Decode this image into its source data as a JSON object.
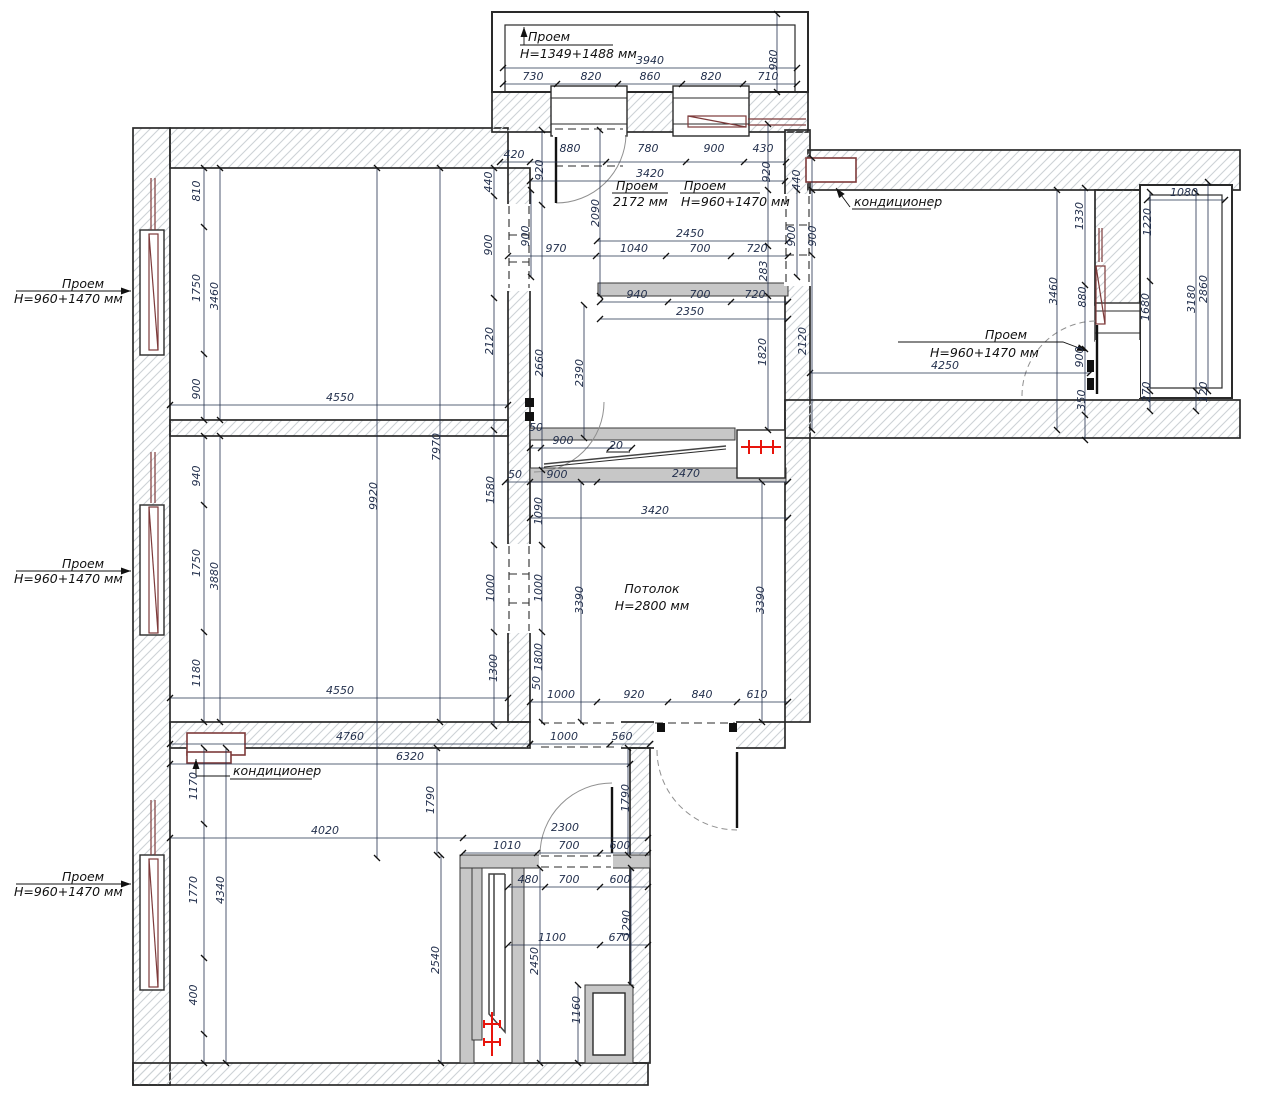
{
  "colors": {
    "dim_text": "#23304d",
    "wall_line": "#2a2a2a",
    "hatch": "#cdd2d6",
    "partition_gray": "#c7c7c7",
    "radiator_red": "#e8140c",
    "window_maroon": "#7d3a3a",
    "door_arc_gray": "#909090"
  },
  "labels": {
    "opening_top": {
      "title": "Проем",
      "size": "H=1349+1488 мм"
    },
    "opening_kitchen": {
      "title": "Проем",
      "size": "2172 мм"
    },
    "opening_kitchen_2": {
      "title": "Проем",
      "size": "H=960+1470 мм"
    },
    "opening_right": {
      "title": "Проем",
      "size": "H=960+1470 мм"
    },
    "opening_left_top": {
      "title": "Проем",
      "size": "H=960+1470 мм"
    },
    "opening_left_middle": {
      "title": "Проем",
      "size": "H=960+1470 мм"
    },
    "opening_left_bottom": {
      "title": "Проем",
      "size": "H=960+1470 мм"
    },
    "ceiling": {
      "title": "Потолок",
      "size": "H=2800 мм"
    },
    "ac_top_right": "кондиционер",
    "ac_bottom_left": "кондиционер"
  },
  "dims": [
    {
      "t": "3940",
      "x": 650,
      "y": 64
    },
    {
      "t": "730",
      "x": 533,
      "y": 80
    },
    {
      "t": "820",
      "x": 591,
      "y": 80
    },
    {
      "t": "860",
      "x": 650,
      "y": 80
    },
    {
      "t": "820",
      "x": 711,
      "y": 80
    },
    {
      "t": "710",
      "x": 768,
      "y": 80
    },
    {
      "t": "980",
      "x": 777,
      "y": 60,
      "r": -90
    },
    {
      "t": "420",
      "x": 514,
      "y": 158
    },
    {
      "t": "880",
      "x": 570,
      "y": 152
    },
    {
      "t": "780",
      "x": 648,
      "y": 152
    },
    {
      "t": "900",
      "x": 714,
      "y": 152
    },
    {
      "t": "430",
      "x": 763,
      "y": 152
    },
    {
      "t": "920",
      "x": 543,
      "y": 170,
      "r": -90
    },
    {
      "t": "920",
      "x": 770,
      "y": 172,
      "r": -90
    },
    {
      "t": "3420",
      "x": 650,
      "y": 177
    },
    {
      "t": "2090",
      "x": 599,
      "y": 213,
      "r": -90
    },
    {
      "t": "900",
      "x": 529,
      "y": 236,
      "r": -90
    },
    {
      "t": "900",
      "x": 795,
      "y": 236,
      "r": -90
    },
    {
      "t": "900",
      "x": 816,
      "y": 236,
      "r": -90
    },
    {
      "t": "2450",
      "x": 690,
      "y": 237
    },
    {
      "t": "970",
      "x": 556,
      "y": 252
    },
    {
      "t": "1040",
      "x": 634,
      "y": 252
    },
    {
      "t": "700",
      "x": 700,
      "y": 252
    },
    {
      "t": "720",
      "x": 757,
      "y": 252
    },
    {
      "t": "283",
      "x": 767,
      "y": 271,
      "r": -90
    },
    {
      "t": "940",
      "x": 637,
      "y": 298
    },
    {
      "t": "700",
      "x": 700,
      "y": 298
    },
    {
      "t": "720",
      "x": 755,
      "y": 298
    },
    {
      "t": "2350",
      "x": 690,
      "y": 315
    },
    {
      "t": "1820",
      "x": 766,
      "y": 352,
      "r": -90
    },
    {
      "t": "2120",
      "x": 493,
      "y": 341,
      "r": -90
    },
    {
      "t": "2120",
      "x": 806,
      "y": 341,
      "r": -90
    },
    {
      "t": "2660",
      "x": 543,
      "y": 363,
      "r": -90
    },
    {
      "t": "2390",
      "x": 583,
      "y": 373,
      "r": -90
    },
    {
      "t": "810",
      "x": 200,
      "y": 191,
      "r": -90
    },
    {
      "t": "1750",
      "x": 200,
      "y": 288,
      "r": -90
    },
    {
      "t": "900",
      "x": 200,
      "y": 389,
      "r": -90
    },
    {
      "t": "3460",
      "x": 218,
      "y": 296,
      "r": -90
    },
    {
      "t": "440",
      "x": 492,
      "y": 182,
      "r": -90
    },
    {
      "t": "900",
      "x": 492,
      "y": 245,
      "r": -90
    },
    {
      "t": "4550",
      "x": 340,
      "y": 401
    },
    {
      "t": "4550",
      "x": 340,
      "y": 694
    },
    {
      "t": "7970",
      "x": 440,
      "y": 447,
      "r": -90
    },
    {
      "t": "9920",
      "x": 377,
      "y": 496,
      "r": -90
    },
    {
      "t": "940",
      "x": 200,
      "y": 476,
      "r": -90
    },
    {
      "t": "1750",
      "x": 200,
      "y": 563,
      "r": -90
    },
    {
      "t": "1180",
      "x": 200,
      "y": 673,
      "r": -90
    },
    {
      "t": "3880",
      "x": 218,
      "y": 576,
      "r": -90
    },
    {
      "t": "1580",
      "x": 494,
      "y": 490,
      "r": -90
    },
    {
      "t": "1090",
      "x": 542,
      "y": 511,
      "r": -90
    },
    {
      "t": "1000",
      "x": 494,
      "y": 588,
      "r": -90
    },
    {
      "t": "1000",
      "x": 542,
      "y": 588,
      "r": -90
    },
    {
      "t": "1300",
      "x": 497,
      "y": 668,
      "r": -90
    },
    {
      "t": "1800",
      "x": 542,
      "y": 657,
      "r": -90
    },
    {
      "t": "3390",
      "x": 583,
      "y": 600,
      "r": -90
    },
    {
      "t": "3390",
      "x": 764,
      "y": 600,
      "r": -90
    },
    {
      "t": "50",
      "x": 536,
      "y": 431
    },
    {
      "t": "900",
      "x": 563,
      "y": 444
    },
    {
      "t": "20",
      "x": 616,
      "y": 449
    },
    {
      "t": "50",
      "x": 515,
      "y": 478
    },
    {
      "t": "900",
      "x": 557,
      "y": 478
    },
    {
      "t": "2470",
      "x": 686,
      "y": 477
    },
    {
      "t": "3420",
      "x": 655,
      "y": 514
    },
    {
      "t": "1000",
      "x": 561,
      "y": 698
    },
    {
      "t": "920",
      "x": 634,
      "y": 698
    },
    {
      "t": "840",
      "x": 702,
      "y": 698
    },
    {
      "t": "610",
      "x": 757,
      "y": 698
    },
    {
      "t": "1000",
      "x": 564,
      "y": 740
    },
    {
      "t": "560",
      "x": 622,
      "y": 740
    },
    {
      "t": "50",
      "x": 540,
      "y": 683,
      "r": -90
    },
    {
      "t": "1790",
      "x": 629,
      "y": 798,
      "r": -90
    },
    {
      "t": "4760",
      "x": 350,
      "y": 740
    },
    {
      "t": "6320",
      "x": 410,
      "y": 760
    },
    {
      "t": "4020",
      "x": 325,
      "y": 834
    },
    {
      "t": "1170",
      "x": 197,
      "y": 786,
      "r": -90
    },
    {
      "t": "1790",
      "x": 434,
      "y": 800,
      "r": -90
    },
    {
      "t": "1770",
      "x": 197,
      "y": 890,
      "r": -90
    },
    {
      "t": "4340",
      "x": 224,
      "y": 890,
      "r": -90
    },
    {
      "t": "400",
      "x": 197,
      "y": 995,
      "r": -90
    },
    {
      "t": "2540",
      "x": 439,
      "y": 960,
      "r": -90
    },
    {
      "t": "2300",
      "x": 565,
      "y": 831
    },
    {
      "t": "1010",
      "x": 507,
      "y": 849
    },
    {
      "t": "700",
      "x": 569,
      "y": 849
    },
    {
      "t": "600",
      "x": 620,
      "y": 849
    },
    {
      "t": "480",
      "x": 528,
      "y": 883
    },
    {
      "t": "700",
      "x": 569,
      "y": 883
    },
    {
      "t": "600",
      "x": 620,
      "y": 883
    },
    {
      "t": "1290",
      "x": 630,
      "y": 924,
      "r": -90
    },
    {
      "t": "1100",
      "x": 552,
      "y": 941
    },
    {
      "t": "670",
      "x": 619,
      "y": 941
    },
    {
      "t": "2450",
      "x": 538,
      "y": 961,
      "r": -90
    },
    {
      "t": "1160",
      "x": 580,
      "y": 1010,
      "r": -90
    },
    {
      "t": "440",
      "x": 800,
      "y": 180,
      "r": -90
    },
    {
      "t": "3460",
      "x": 1057,
      "y": 291,
      "r": -90
    },
    {
      "t": "1330",
      "x": 1083,
      "y": 216,
      "r": -90
    },
    {
      "t": "880",
      "x": 1086,
      "y": 297,
      "r": -90
    },
    {
      "t": "1680",
      "x": 1149,
      "y": 307,
      "r": -90
    },
    {
      "t": "1080",
      "x": 1184,
      "y": 196
    },
    {
      "t": "1220",
      "x": 1151,
      "y": 222,
      "r": -90
    },
    {
      "t": "3180",
      "x": 1195,
      "y": 299,
      "r": -90
    },
    {
      "t": "2860",
      "x": 1207,
      "y": 289,
      "r": -90
    },
    {
      "t": "900",
      "x": 1083,
      "y": 357,
      "r": -90
    },
    {
      "t": "270",
      "x": 1150,
      "y": 392,
      "r": -90
    },
    {
      "t": "120",
      "x": 1207,
      "y": 392,
      "r": -90
    },
    {
      "t": "350",
      "x": 1085,
      "y": 400,
      "r": -90
    },
    {
      "t": "4250",
      "x": 945,
      "y": 369
    }
  ]
}
